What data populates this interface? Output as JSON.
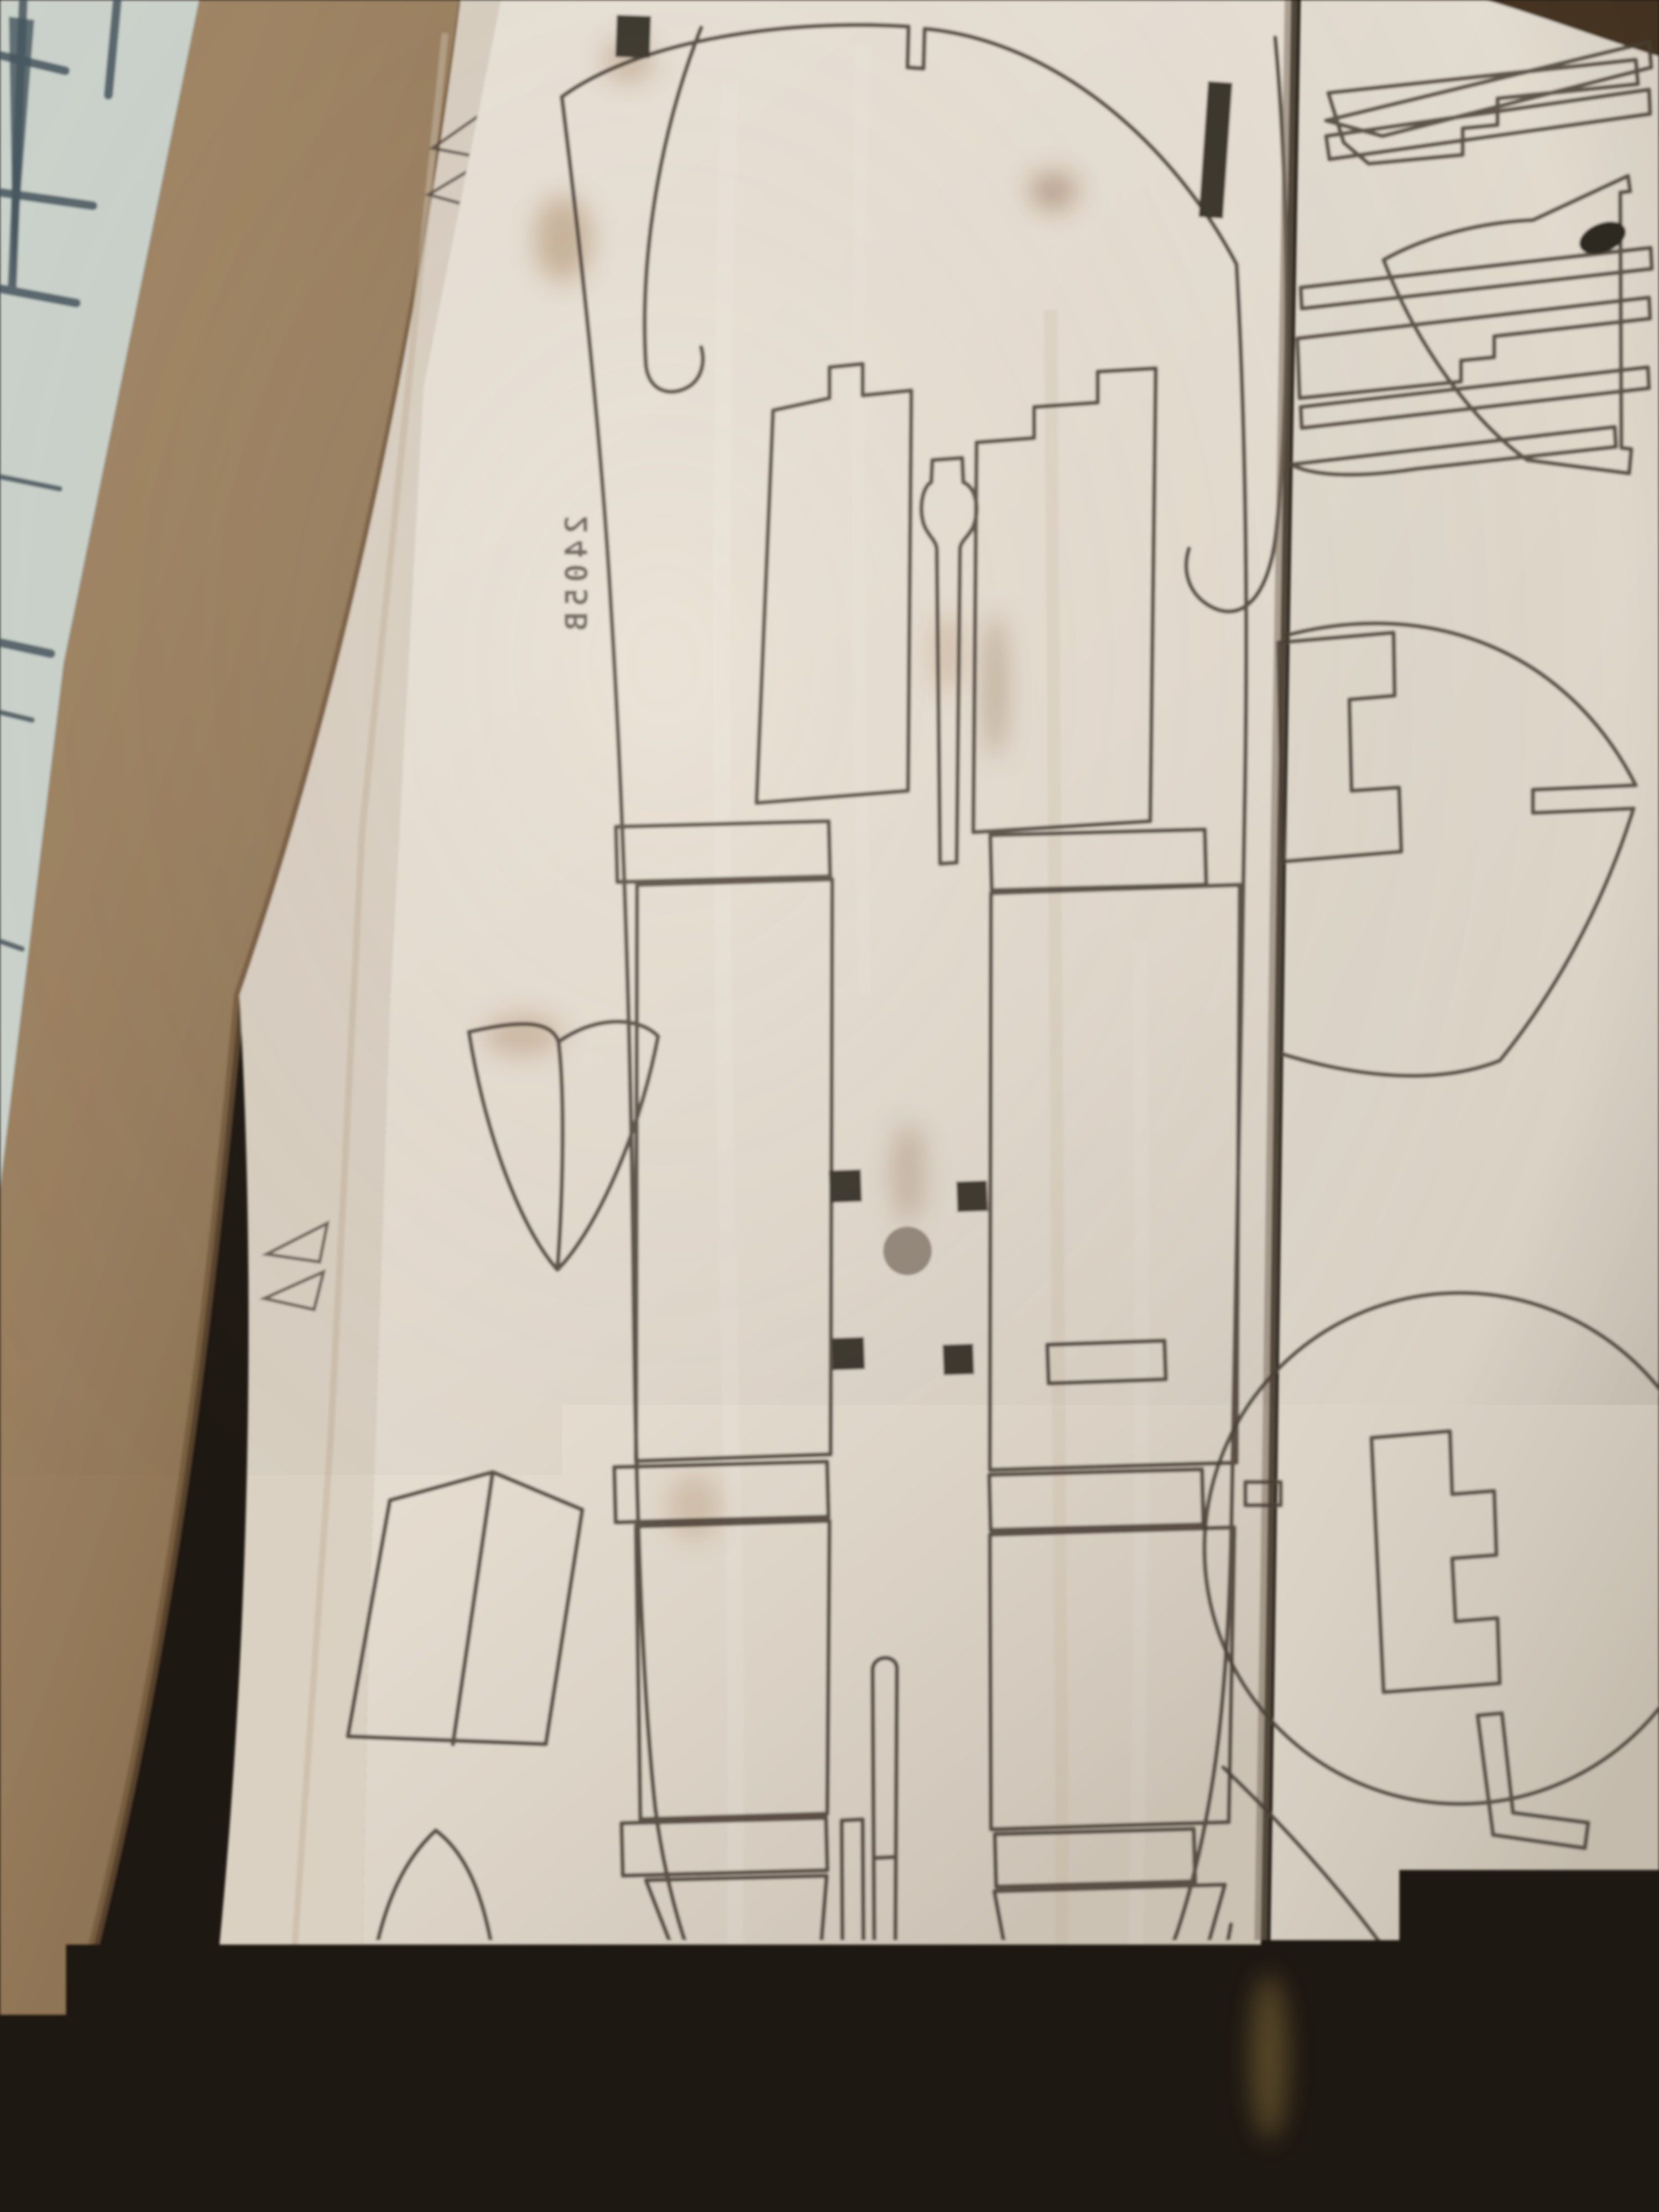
{
  "sheet_main": {
    "etched_label": "2405B"
  },
  "colors": {
    "window_surface": "#cdd5ce",
    "window_line": "#46565f",
    "cardboard": "#9a7b54",
    "cardboard_dark": "#6f5538",
    "box_shadow": "#473624",
    "sheet_under": "#dbd1c3",
    "sheet_main": "#e7ded1",
    "sheet_right": "#ded6c8",
    "cut_line": "#4a3f35",
    "etch_text": "#413a32",
    "hole_dark": "#3e382f",
    "hole_round": "#96897b",
    "stain_brown": "#96683c",
    "stain_yellow": "#c2a050",
    "shadow_gap": "#7c6e5c"
  }
}
